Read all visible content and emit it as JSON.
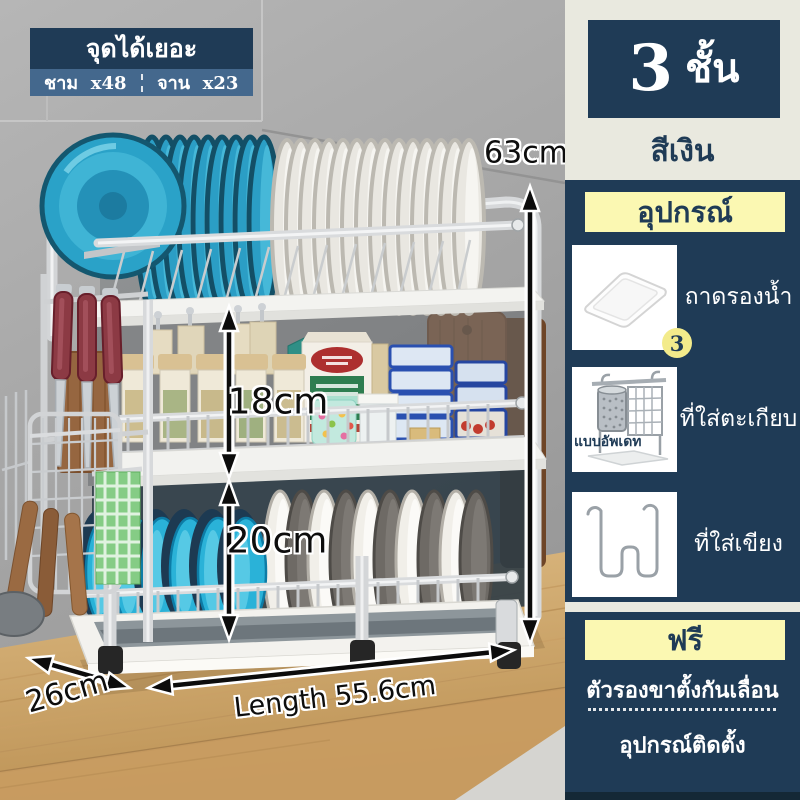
{
  "badge": {
    "title": "จุดได้เยอะ",
    "item1_label": "ชาม",
    "item1_count": "x48",
    "item2_label": "จาน",
    "item2_count": "x23"
  },
  "product": {
    "tiers_number": "3",
    "tiers_unit": "ชั้น",
    "color_name": "สีเงิน"
  },
  "accessories": {
    "header": "อุปกรณ์",
    "items": [
      {
        "name": "ถาดรองน้ำ",
        "qty_badge": "3",
        "icon": "drip-tray-icon"
      },
      {
        "name": "ที่ใส่ตะเกียบ",
        "variant_note": "แบบอัพเดท",
        "icon": "chopstick-holder-icon"
      },
      {
        "name": "ที่ใส่เขียง",
        "icon": "cutting-board-hook-icon"
      }
    ]
  },
  "free_section": {
    "header": "ฟรี",
    "line1": "ตัวรองขาตั้งกันเลื่อน",
    "line2": "อุปกรณ์ติดตั้ง"
  },
  "dimensions": {
    "total_height": "63cm",
    "middle_tier_height": "18cm",
    "bottom_tier_height": "20cm",
    "depth": "26cm",
    "length": "Length 55.6cm"
  },
  "colors": {
    "navy": "#1f3b56",
    "steel_blue": "#44688d",
    "cream": "#e9e9df",
    "pale_yellow": "#fbf8b2",
    "badge_yellow": "#f3eb8b",
    "plate_blue": "#2ba4c9",
    "bowl_cyan": "#2ab2d8",
    "wood": "#cfa268"
  }
}
